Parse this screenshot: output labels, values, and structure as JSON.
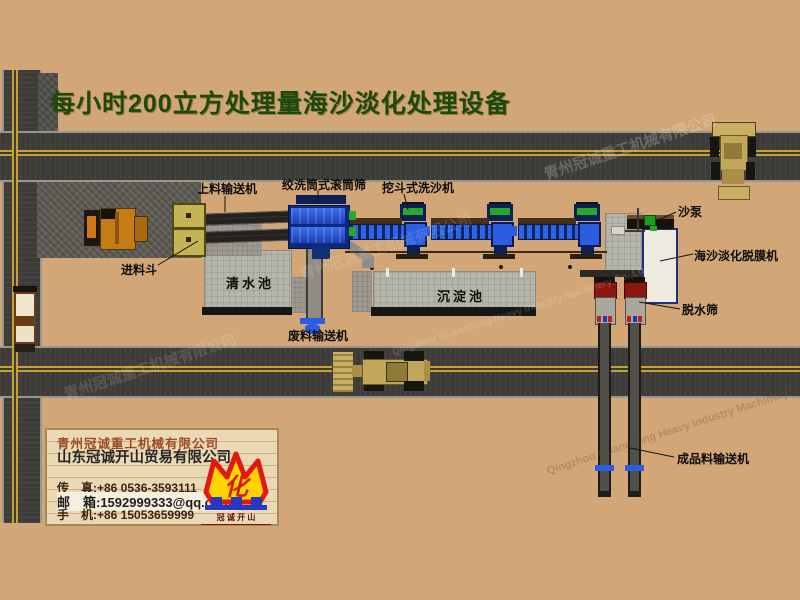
{
  "title": "每小时200立方处理量海沙淡化处理设备",
  "equipment_labels": {
    "feed_conveyor": "上料输送机",
    "drum_screen": "绞洗筒式滚筒筛",
    "bucket_washer": "挖斗式洗沙机",
    "feed_hopper": "进料斗",
    "clean_water_pool": "清水池",
    "sediment_pool": "沉淀池",
    "waste_conveyor": "废料输送机",
    "sand_pump": "沙泵",
    "desalination_machine": "海沙淡化脱膜机",
    "dewatering_screen": "脱水筛",
    "product_conveyor": "成品料输送机"
  },
  "company_box": {
    "company_machinery": "青州冠诚重工机械有限公司",
    "company_trade": "山东冠诚开山贸易有限公司",
    "fax": "传　真:+86 0536-3593111",
    "email": "邮　箱:1592999333@qq.com",
    "mobile": "手　机:+86 15053659999",
    "logo_glyph": "化",
    "logo_caption": "冠 诚 开 山"
  },
  "watermarks": {
    "cn": "青州冠诚重工机械有限公司",
    "en": "Qingzhou Guancheng Heavy Industry Machinery Co.,Ltd"
  },
  "colors": {
    "background": "#d2a676",
    "title_green": "#1c4a0a",
    "road": "#3d3c38",
    "road_line_yellow": "#c7a233",
    "machine_blue": "#2b5de0",
    "motor_green": "#2aa62a",
    "pool_gray": "#b6b5aa",
    "crown_yellow": "#ffd400",
    "crown_red": "#dd1c10",
    "logo_blue": "#2438c0"
  }
}
